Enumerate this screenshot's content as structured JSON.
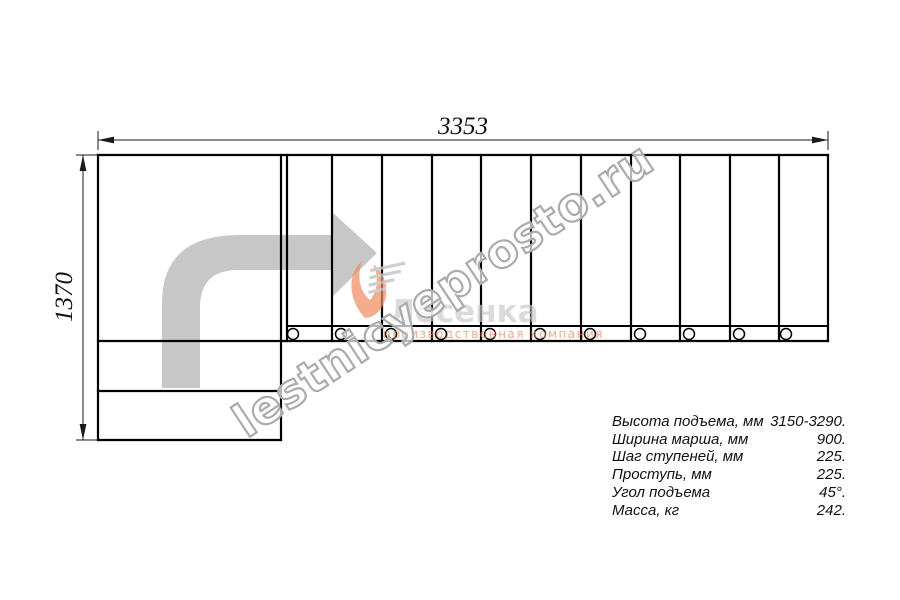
{
  "dimensions": {
    "width_label": "3353",
    "height_label": "1370"
  },
  "specs": {
    "rows": [
      {
        "label": "Высота подъема, мм",
        "value": "3150-3290."
      },
      {
        "label": "Ширина марша, мм",
        "value": "900."
      },
      {
        "label": "Шаг ступеней, мм",
        "value": "225."
      },
      {
        "label": "Проступь, мм",
        "value": "225."
      },
      {
        "label": "Угол подъема",
        "value": "45°."
      },
      {
        "label": "Масса, кг",
        "value": "242."
      }
    ]
  },
  "watermark": {
    "text": "lestnicyeprosto.ru"
  },
  "logo": {
    "name": "Лесенка",
    "tagline": "производственная компания"
  },
  "colors": {
    "line_black": "#000000",
    "arrow_gray": "#c7c7c7",
    "logo_orange": "#ef8e63",
    "logo_gray": "#cbcbcb",
    "watermark_stroke": "#ababab"
  }
}
